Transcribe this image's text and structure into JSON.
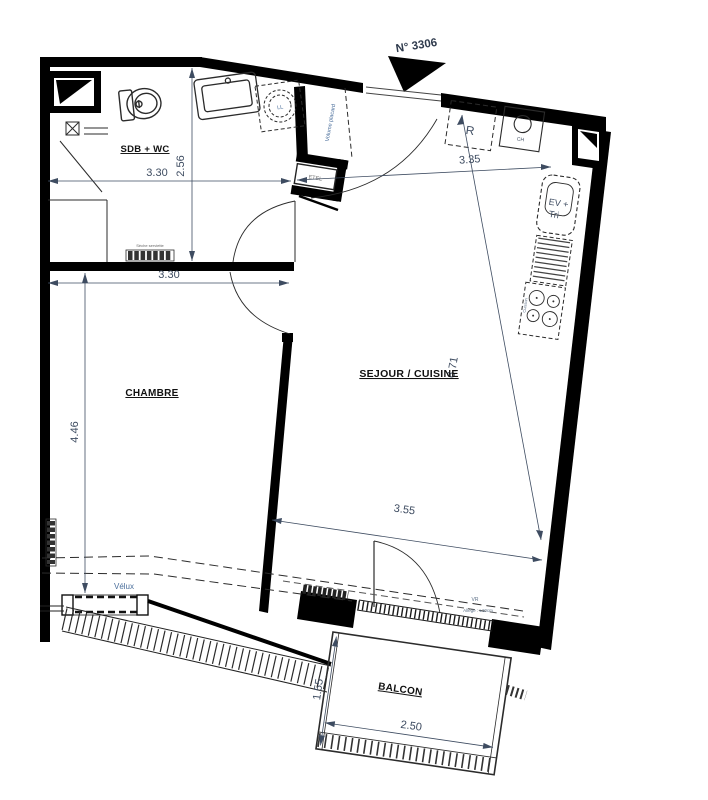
{
  "plan": {
    "unit_number": "N° 3306",
    "north_arrow": "north-arrow-icon",
    "colors": {
      "wall": "#000000",
      "line": "#2b2b2b",
      "dimension_text": "#3e4c61",
      "annotation_text": "#4a6e9b",
      "room_label": "#111111",
      "background": "#ffffff"
    },
    "rooms": {
      "bathroom": {
        "label": "SDB + WC",
        "width_m": "3.30",
        "depth_m": "2.56"
      },
      "bedroom": {
        "label": "CHAMBRE",
        "width_m": "3.30",
        "depth_m": "4.46"
      },
      "living_kitchen": {
        "label": "SEJOUR / CUISINE",
        "kitchen_width_m": "3.35",
        "length_m": "6.71",
        "bay_width_m": "3.55"
      },
      "balcony": {
        "label": "BALCON",
        "depth_m": "1.55",
        "width_m": "2.50"
      }
    },
    "fixtures": {
      "washing_machine": "LL",
      "fridge": "R",
      "water_heater": "CH",
      "sink_unit_line1": "EV +",
      "sink_unit_line2": "Tri",
      "cooktop": "Cuisson",
      "electrical_box": "ETEL",
      "closet": "Volume placard",
      "towel_dryer": "Sèche serviette",
      "skylight": "Vélux",
      "roller_shutter": "VR",
      "sill_note": "Allege : ±10cm"
    }
  }
}
